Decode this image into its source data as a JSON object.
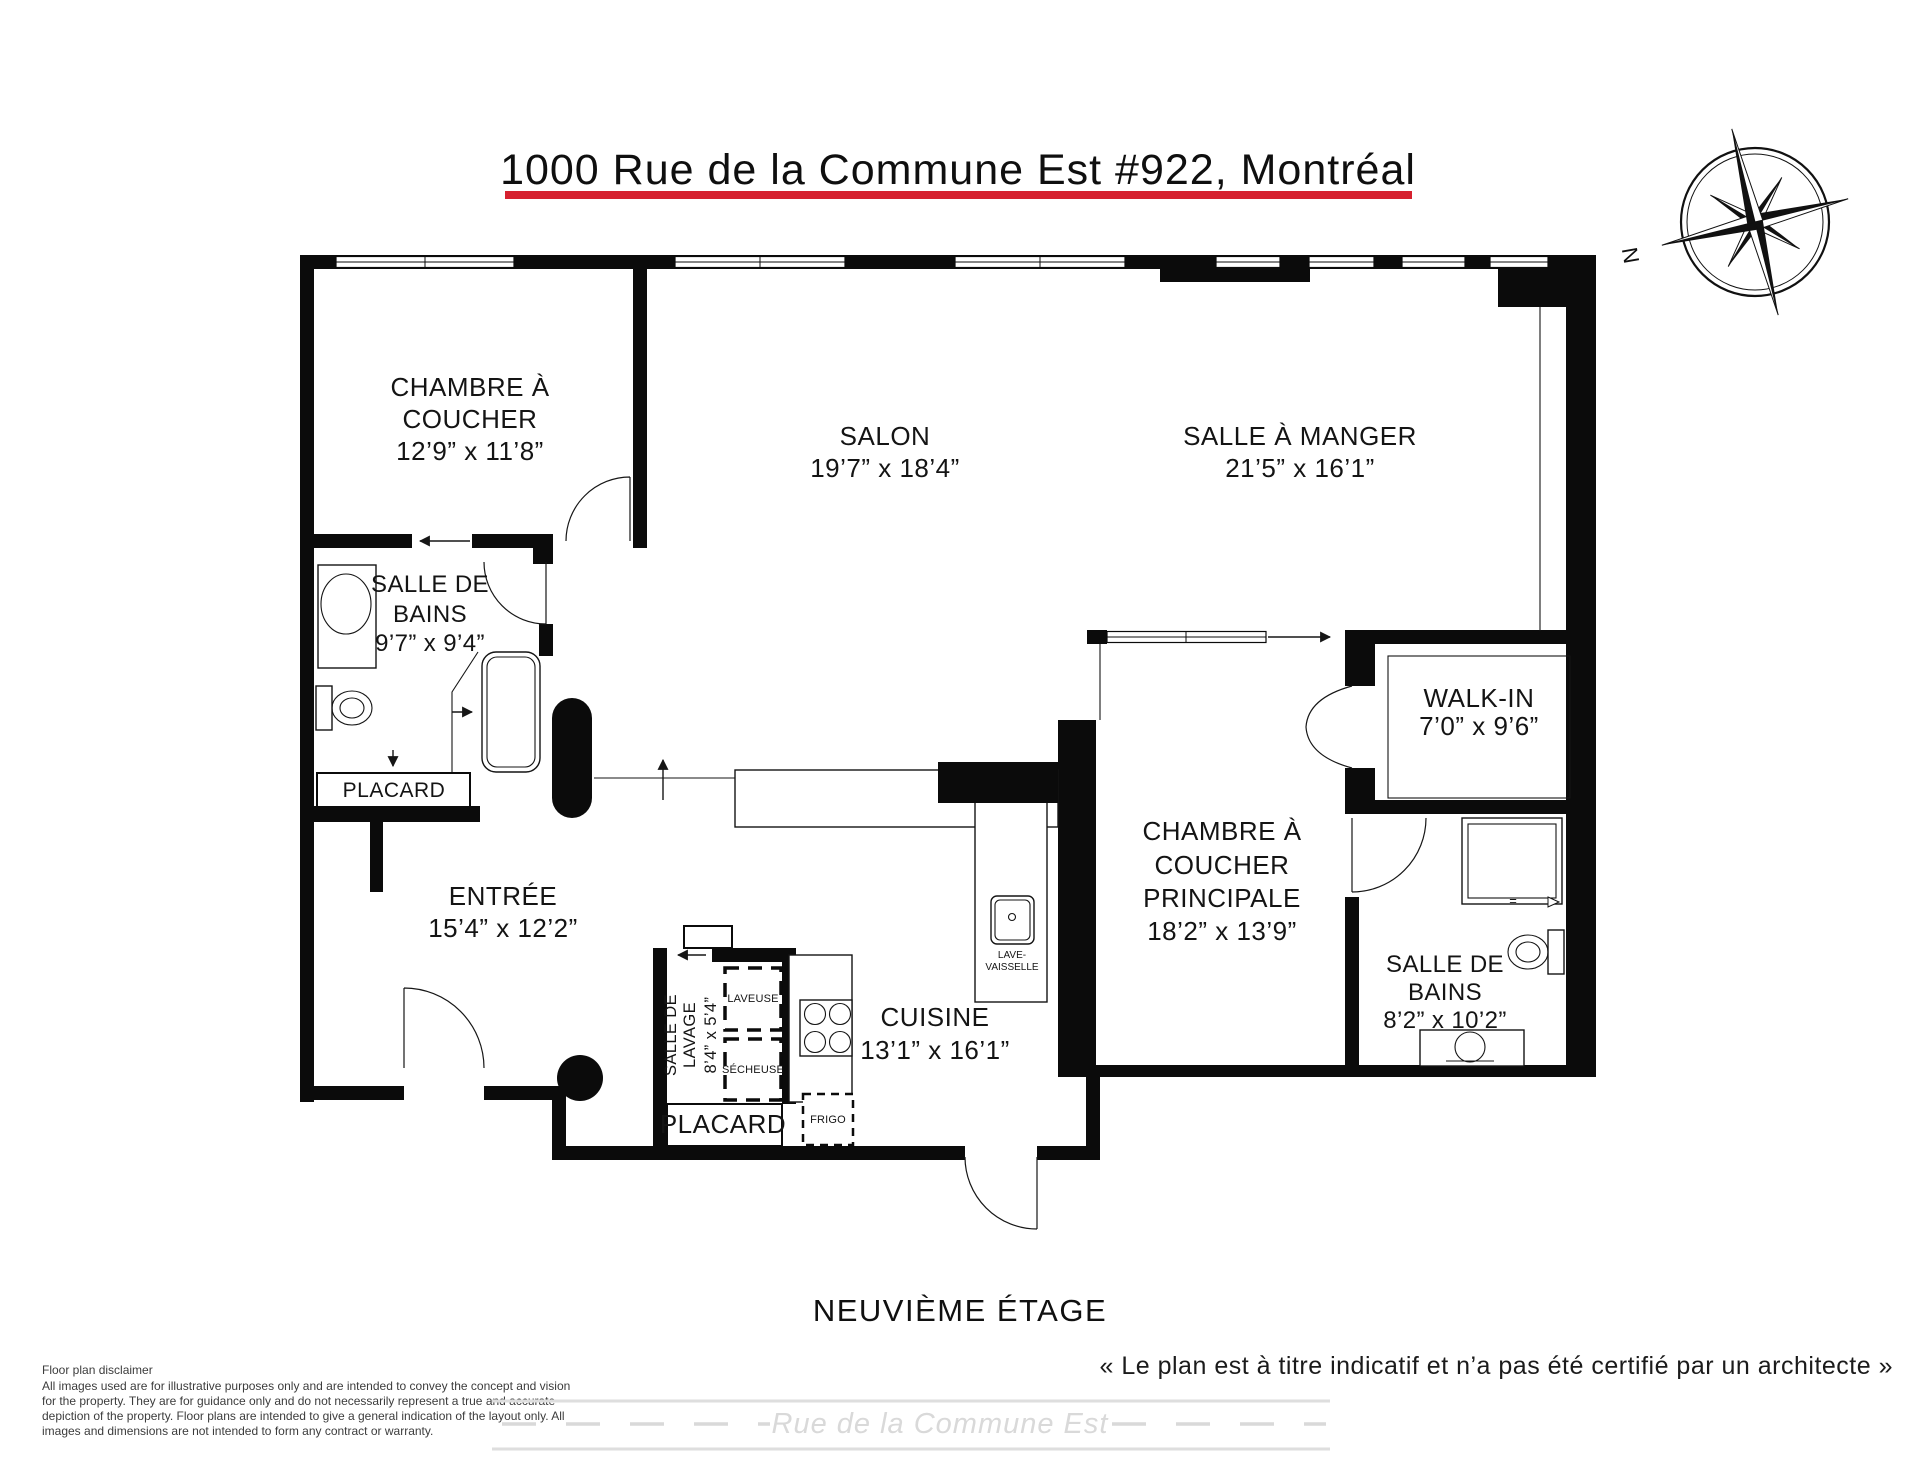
{
  "header": {
    "title": "1000 Rue de la Commune Est #922, Montréal",
    "underline_color": "#d6212f"
  },
  "compass": {
    "north_label": "N"
  },
  "rooms": {
    "bedroom1": {
      "line1": "CHAMBRE À",
      "line2": "COUCHER",
      "dims": "12’9” x 11’8”"
    },
    "salon": {
      "name": "SALON",
      "dims": "19’7” x 18’4”"
    },
    "dining": {
      "name": "SALLE À MANGER",
      "dims": "21’5” x 16’1”"
    },
    "bath1": {
      "line1": "SALLE DE",
      "line2": "BAINS",
      "dims": "9’7” x 9’4”"
    },
    "closet1": {
      "name": "PLACARD"
    },
    "entry": {
      "name": "ENTRÉE",
      "dims": "15’4” x 12’2”"
    },
    "walkin": {
      "name": "WALK-IN",
      "dims": "7’0” x 9’6”"
    },
    "master": {
      "line1": "CHAMBRE À",
      "line2": "COUCHER",
      "line3": "PRINCIPALE",
      "dims": "18’2” x 13’9”"
    },
    "bath2": {
      "line1": "SALLE DE",
      "line2": "BAINS",
      "dims": "8’2” x 10’2”"
    },
    "laundry": {
      "line1": "SALLE DE",
      "line2": "LAVAGE",
      "dims": "8’4” x 5’4”"
    },
    "kitchen": {
      "name": "CUISINE",
      "dims": "13’1” x 16’1”"
    },
    "closet2": {
      "name": "PLACARD"
    }
  },
  "fixtures": {
    "washer": "LAVEUSE",
    "dryer": "SÉCHEUSE",
    "fridge": "FRIGO",
    "dishwasher_line1": "LAVE-",
    "dishwasher_line2": "VAISSELLE",
    "shower_mark": "="
  },
  "footer": {
    "floor_label": "NEUVIÈME ÉTAGE",
    "disclaimer_title": "Floor plan disclaimer",
    "disclaimer_line1": "All images used are for illustrative purposes only and are intended to convey the concept and vision",
    "disclaimer_line2": "for the property. They are for guidance only and do not necessarily represent a true and accurate",
    "disclaimer_line3": "depiction of the property. Floor plans are intended to give a general indication of the layout only. All",
    "disclaimer_line4": "images and dimensions are not intended to form any contract or warranty.",
    "quote": "« Le plan est à titre indicatif et n’a pas été certifié par un architecte »",
    "street_name": "Rue de la Commune Est"
  }
}
